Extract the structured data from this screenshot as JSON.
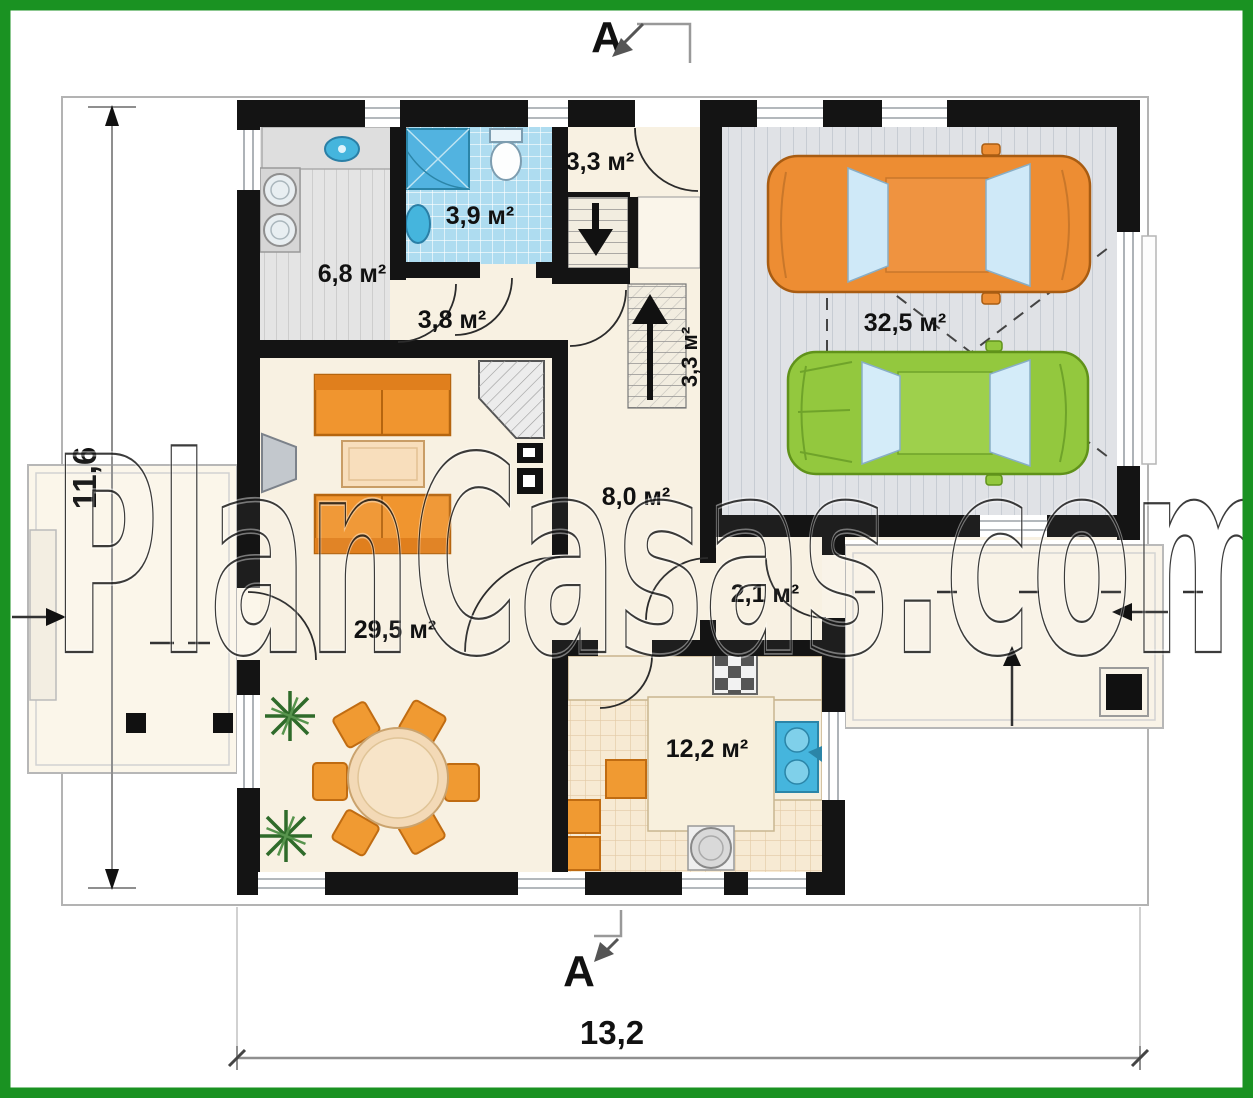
{
  "watermark": "PlanCasas.com",
  "section_markers": {
    "top": "A",
    "bottom": "A"
  },
  "dimensions": {
    "overall_width": "13,2",
    "overall_height": "11,6"
  },
  "rooms": [
    {
      "name": "entrance-vestibule",
      "label": "3,3 м²"
    },
    {
      "name": "bathroom",
      "label": "3,9 м²"
    },
    {
      "name": "utility-room",
      "label": "6,8 м²"
    },
    {
      "name": "hallway",
      "label": "3,8 м²"
    },
    {
      "name": "staircase",
      "label": "3,3 м²"
    },
    {
      "name": "hall",
      "label": "8,0 м²"
    },
    {
      "name": "garage",
      "label": "32,5 м²"
    },
    {
      "name": "living-room",
      "label": "29,5 м²"
    },
    {
      "name": "entry-lobby",
      "label": "2,1 м²"
    },
    {
      "name": "kitchen",
      "label": "12,2 м²"
    }
  ],
  "colors": {
    "frame_green": "#1a9222",
    "wall_black": "#141414",
    "floor_cream": "#f8f1e2",
    "bath_blue": "#aedcf0",
    "fixture_blue": "#45b5dd",
    "furniture_orange": "#f0952f",
    "car_orange": "#ed8d33",
    "car_green": "#93c83e",
    "garage_gray": "#e0e2e6"
  }
}
